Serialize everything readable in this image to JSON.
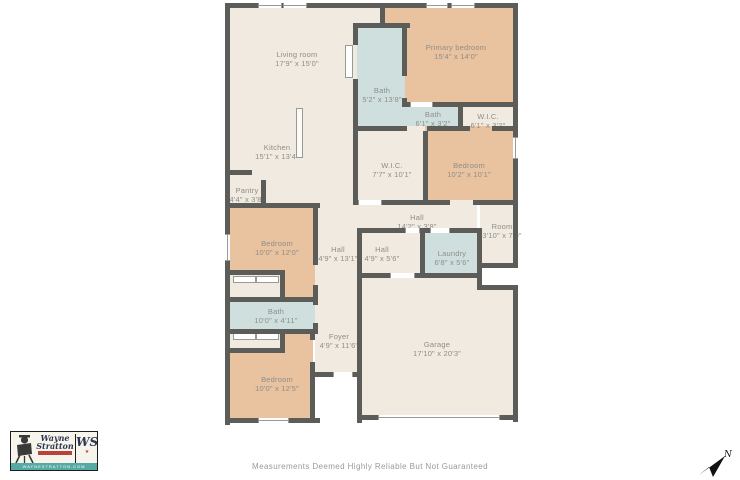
{
  "floorplan": {
    "rooms": [
      {
        "name": "Living room",
        "dims": "17'9\" x 15'0\""
      },
      {
        "name": "Primary bedroom",
        "dims": "15'4\" x 14'0\""
      },
      {
        "name": "Bath",
        "dims": "5'2\" x 13'8\""
      },
      {
        "name": "Bath",
        "dims": "6'1\" x 3'2\""
      },
      {
        "name": "W.I.C.",
        "dims": "6'1\" x 3'2\""
      },
      {
        "name": "Kitchen",
        "dims": "15'1\" x 13'4\""
      },
      {
        "name": "W.I.C.",
        "dims": "7'7\" x 10'1\""
      },
      {
        "name": "Bedroom",
        "dims": "10'2\" x 10'1\""
      },
      {
        "name": "Pantry",
        "dims": "4'4\" x 3'8\""
      },
      {
        "name": "Hall",
        "dims": "14'2\" x 3'8\""
      },
      {
        "name": "Room",
        "dims": "3'10\" x 7'0\""
      },
      {
        "name": "Bedroom",
        "dims": "10'0\" x 12'0\""
      },
      {
        "name": "Hall",
        "dims": "4'9\" x 13'1\""
      },
      {
        "name": "Hall",
        "dims": "4'9\" x 5'6\""
      },
      {
        "name": "Laundry",
        "dims": "6'8\" x 5'6\""
      },
      {
        "name": "Bath",
        "dims": "10'0\" x 4'11\""
      },
      {
        "name": "Foyer",
        "dims": "4'9\" x 11'6\""
      },
      {
        "name": "Garage",
        "dims": "17'10\" x 20'3\""
      },
      {
        "name": "Bedroom",
        "dims": "10'0\" x 12'5\""
      }
    ],
    "colors": {
      "floor": "#f0eae1",
      "bedroom": "#e9c29f",
      "bath": "#cfdfde",
      "outside": "#ffffff",
      "wall": "#5c5c59",
      "label": "#8f8e88",
      "window_line": "#9a9a94"
    }
  },
  "branding": {
    "logo": {
      "line1": "Wayne",
      "line2": "Stratton",
      "monogram": "WS",
      "star": "★",
      "website": "WAYNESTRATTON.COM",
      "accent_red": "#b5453c",
      "band_teal": "#55aaa5",
      "ink_navy": "#2e3752"
    }
  },
  "footer": {
    "disclaimer": "Measurements Deemed Highly Reliable But Not Guaranteed"
  },
  "compass": {
    "north_label": "N"
  }
}
